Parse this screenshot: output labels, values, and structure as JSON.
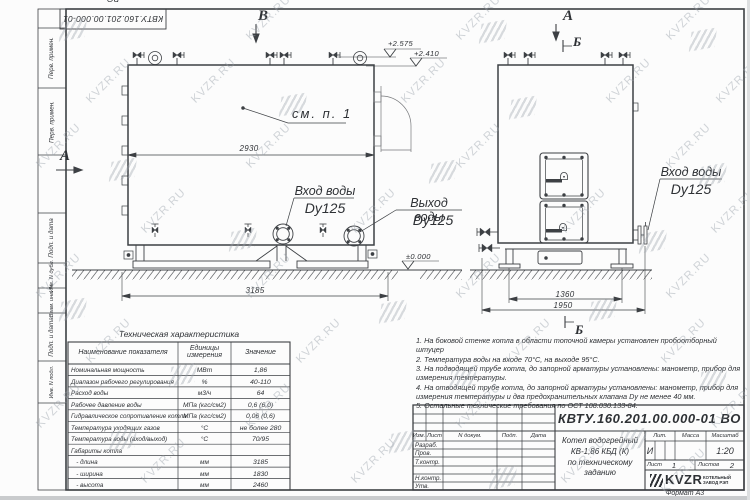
{
  "colors": {
    "line": "#3d4044",
    "thin_line": "#77797c",
    "text": "#2e3135",
    "watermark": "#9aa2ab"
  },
  "frame": {
    "stamp_top": "КВТУ.160.201.00.000-01 ВО",
    "margin_labels": [
      "Перв. примен.",
      "Перв. примен.",
      "Подп. и дата",
      "Инв. N дубл.",
      "Взам. инв. N",
      "Подп. и дата",
      "Инв. N подл."
    ]
  },
  "views": {
    "view_b": "В",
    "view_a_left": "А",
    "view_a_right": "А",
    "section_b_top": "Б",
    "section_b_bottom": "Б",
    "see_note": "см. п. 1",
    "dims": {
      "body_width": "2930",
      "overall_length": "3185",
      "front_width": "1360",
      "front_overall": "1950"
    },
    "elevations": {
      "valve_top": "+2.575",
      "flange_top": "+2.410",
      "ground": "±0.000"
    },
    "nozzles": {
      "inlet_side": {
        "title": "Вход воды",
        "size": "Dy125"
      },
      "outlet_side": {
        "title": "Выход воды",
        "size": "Dy125"
      },
      "inlet_front": {
        "title": "Вход воды",
        "size": "Dy125"
      }
    }
  },
  "spec_table": {
    "title": "Техническая характеристика",
    "headers": {
      "name": "Наименование показателя",
      "unit": "Единицы\nизмерения",
      "value": "Значение"
    },
    "rows": [
      {
        "name": "Номинальная мощность",
        "unit": "МВт",
        "value": "1,86"
      },
      {
        "name": "Диапазон рабочего регулирования",
        "unit": "%",
        "value": "40-110"
      },
      {
        "name": "Расход воды",
        "unit": "м3/ч",
        "value": "64"
      },
      {
        "name": "Рабочее давление воды",
        "unit": "МПа (кгс/см2)",
        "value": "0,6 (6,0)"
      },
      {
        "name": "Гидравлическое сопротивление котла",
        "unit": "МПа (кгс/см2)",
        "value": "0,06 (0,6)"
      },
      {
        "name": "Температура уходящих газов",
        "unit": "°С",
        "value": "не более 280"
      },
      {
        "name": "Температура воды (вход/выход)",
        "unit": "°С",
        "value": "70/95"
      },
      {
        "name": "Габариты котла",
        "unit": "",
        "value": ""
      },
      {
        "name": "   - длина",
        "unit": "мм",
        "value": "3185"
      },
      {
        "name": "   - ширина",
        "unit": "мм",
        "value": "1830"
      },
      {
        "name": "   - высота",
        "unit": "мм",
        "value": "2460"
      }
    ]
  },
  "notes": {
    "items": [
      "1.  На боковой стенке котла в области топочной камеры установлен пробоотборный штуцер",
      "2.  Температура воды на входе 70°С, на выходе 95°С.",
      "3.  На подводящей трубе котла, до запорной арматуры установлены: манометр, прибор для измерения температуры.",
      "4.  На отводящей трубе котла, до запорной арматуры установлены: манометр, прибор для измерения температуры и два предохранительных клапана Dу не менее 40 мм.",
      "5.  Остальные технические требования по ОСТ 108.030.133-84."
    ]
  },
  "title_block": {
    "designation": "КВТУ.160.201.00.000-01 ВО",
    "doc_name": "Котел водогрейный\nКВ-1,86 КБД (К)\nпо техническому заданию",
    "rev_headers": [
      "Изм.",
      "Лист",
      "N докум.",
      "Подп.",
      "Дата"
    ],
    "row_labels": [
      "Разраб.",
      "Пров.",
      "Т.контр.",
      "Н.контр.",
      "Утв."
    ],
    "lit_header": "Лит.",
    "mass_header": "Масса",
    "scale_header": "Масштаб",
    "lit_value": "И",
    "scale_value": "1:20",
    "sheet_label": "Лист",
    "sheet_value": "1",
    "sheets_label": "Листов",
    "sheets_value": "2",
    "company": "KVZR",
    "company_sub": "КОТЕЛЬНЫЙ\nЗАВОД РЭП",
    "format_label": "Формат  А3"
  },
  "watermark": {
    "text": "KVZR.RU",
    "text_positions": [
      [
        240,
        12
      ],
      [
        450,
        12
      ],
      [
        660,
        12
      ],
      [
        80,
        75
      ],
      [
        185,
        75
      ],
      [
        395,
        75
      ],
      [
        600,
        75
      ],
      [
        710,
        75
      ],
      [
        30,
        140
      ],
      [
        240,
        140
      ],
      [
        450,
        140
      ],
      [
        660,
        140
      ],
      [
        135,
        205
      ],
      [
        345,
        205
      ],
      [
        555,
        205
      ],
      [
        705,
        205
      ],
      [
        30,
        270
      ],
      [
        240,
        270
      ],
      [
        450,
        270
      ],
      [
        660,
        270
      ],
      [
        80,
        335
      ],
      [
        290,
        335
      ],
      [
        500,
        335
      ],
      [
        655,
        335
      ],
      [
        30,
        400
      ],
      [
        240,
        400
      ],
      [
        450,
        400
      ],
      [
        705,
        400
      ],
      [
        135,
        455
      ],
      [
        345,
        455
      ],
      [
        555,
        455
      ],
      [
        655,
        465
      ]
    ],
    "logo_positions": [
      [
        60,
        20
      ],
      [
        480,
        22
      ],
      [
        690,
        30
      ],
      [
        280,
        95
      ],
      [
        510,
        98
      ],
      [
        110,
        160
      ],
      [
        430,
        162
      ],
      [
        700,
        165
      ],
      [
        230,
        230
      ],
      [
        640,
        232
      ],
      [
        60,
        300
      ],
      [
        380,
        302
      ],
      [
        590,
        300
      ],
      [
        170,
        365
      ],
      [
        450,
        368
      ],
      [
        700,
        370
      ],
      [
        110,
        430
      ],
      [
        390,
        432
      ],
      [
        620,
        430
      ],
      [
        490,
        468
      ]
    ]
  }
}
